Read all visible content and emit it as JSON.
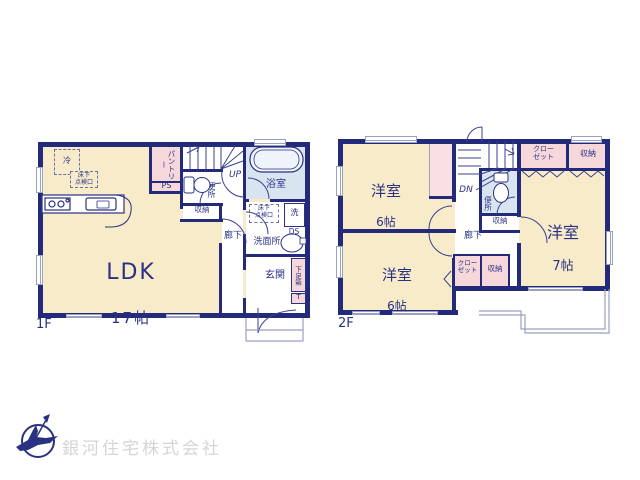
{
  "company": {
    "name": "銀河住宅株式会社"
  },
  "floor1": {
    "label": "1F",
    "ldk": {
      "name": "LDK",
      "size": "17帖"
    },
    "fridge": "冷",
    "floor_hatch": "床下\n点検口",
    "pantry": "パントリー",
    "ps": "PS",
    "up": "UP",
    "toilet": "便所",
    "closet": "収納",
    "hallway": "廊下",
    "bathroom": "浴室",
    "washer": "洗",
    "ds": "DS",
    "washroom": "洗面所",
    "wash_hatch": "床下\n点検口",
    "entrance": "玄関",
    "shoebox": "下足箱",
    "shoebox_t": "T"
  },
  "floor2": {
    "label": "2F",
    "room_nw": {
      "name": "洋室",
      "size": "6帖"
    },
    "room_sw": {
      "name": "洋室",
      "size": "6帖"
    },
    "room_e": {
      "name": "洋室",
      "size": "7帖"
    },
    "dn": "DN",
    "toilet": "便所",
    "hallway": "廊下",
    "closet_n": "クロー\nゼット",
    "storage_n": "収納",
    "storage_mid": "収納",
    "closet_s": "クロー\nゼット",
    "storage_s": "収納"
  },
  "colors": {
    "wall": "#232a7a",
    "text": "#2a3183",
    "room_cream": "#f8ebca",
    "closet_pink": "#f6d8db",
    "wet_blue": "#d8e5f1",
    "thin_line": "#99a1c0",
    "logo_text": "#d5d5d5",
    "logo_mark": "#2a3183"
  }
}
